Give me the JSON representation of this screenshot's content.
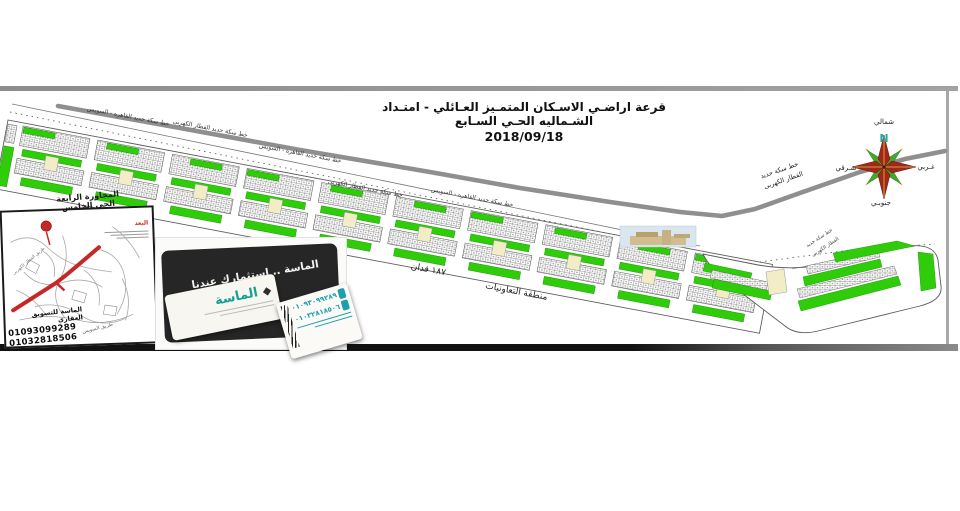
{
  "title": {
    "line1": "قرعة اراضـي الاسـكان المتمـيز العـائلي - امتـداد الشـماليه الحـي السـابع",
    "date": "2018/09/18"
  },
  "compass": {
    "north": "شمالي",
    "south": "جنوبـي",
    "east": "شـرقي",
    "west": "غـربي",
    "n_letter": "N"
  },
  "railways": {
    "cairo_suez": "خط سكة حديد القاهره - السويس",
    "electric": "خط سكة حديد القطار الكهربى",
    "electric_l1": "خط سكة حديد",
    "electric_l2": "القطار الكهربى"
  },
  "plan": {
    "area_feddan": "١٨٧ فدان",
    "cooperatives_zone": "منطقة التعاونيات"
  },
  "inset": {
    "title_line1": "المجاورة الرابعة",
    "title_line2": "الحي الخامس",
    "legend_title": "البعد",
    "road_electric": "طريق القطار الكهربى",
    "road_suez": "طريق السويس",
    "agency": "الماسة للتسويق العقاري",
    "phone1": "01093099289",
    "phone2": "01032818506"
  },
  "card": {
    "slogan": "الماسة .. استثمارك عندنا",
    "brand": "الماسة",
    "diamond": "◆",
    "phone1": "٠١٠٩٣٠٩٩٢٨٩",
    "phone2": "٠١٠٣٢٨١٨٥٠٦"
  },
  "strip": {
    "block_count": 10
  },
  "colors": {
    "green": "#2FCC0A",
    "green_stroke": "#1A8A00",
    "cream": "#F2EDC6",
    "rail_gray": "#8F8F8F",
    "red": "#C62828",
    "teal": "#17A093",
    "dark_tile": "#262626"
  }
}
